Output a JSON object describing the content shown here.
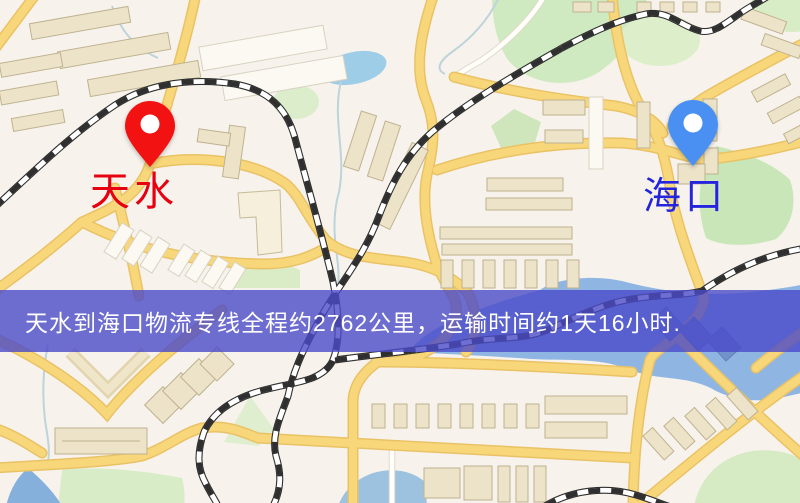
{
  "banner": {
    "text": "天水到海口物流专线全程约2762公里，运输时间约1天16小时.",
    "bg_color": "#4a4ac8",
    "text_color": "#ffffff"
  },
  "markers": [
    {
      "name": "tianshui",
      "label": "天水",
      "pin_color": "#f21212",
      "label_color": "#e60010"
    },
    {
      "name": "haikou",
      "label": "海口",
      "pin_color": "#4a90f2",
      "label_color": "#2424dd"
    }
  ],
  "route": {
    "origin": "天水",
    "destination": "海口",
    "distance_text": "约2762公里",
    "duration_text": "约1天16小时"
  }
}
